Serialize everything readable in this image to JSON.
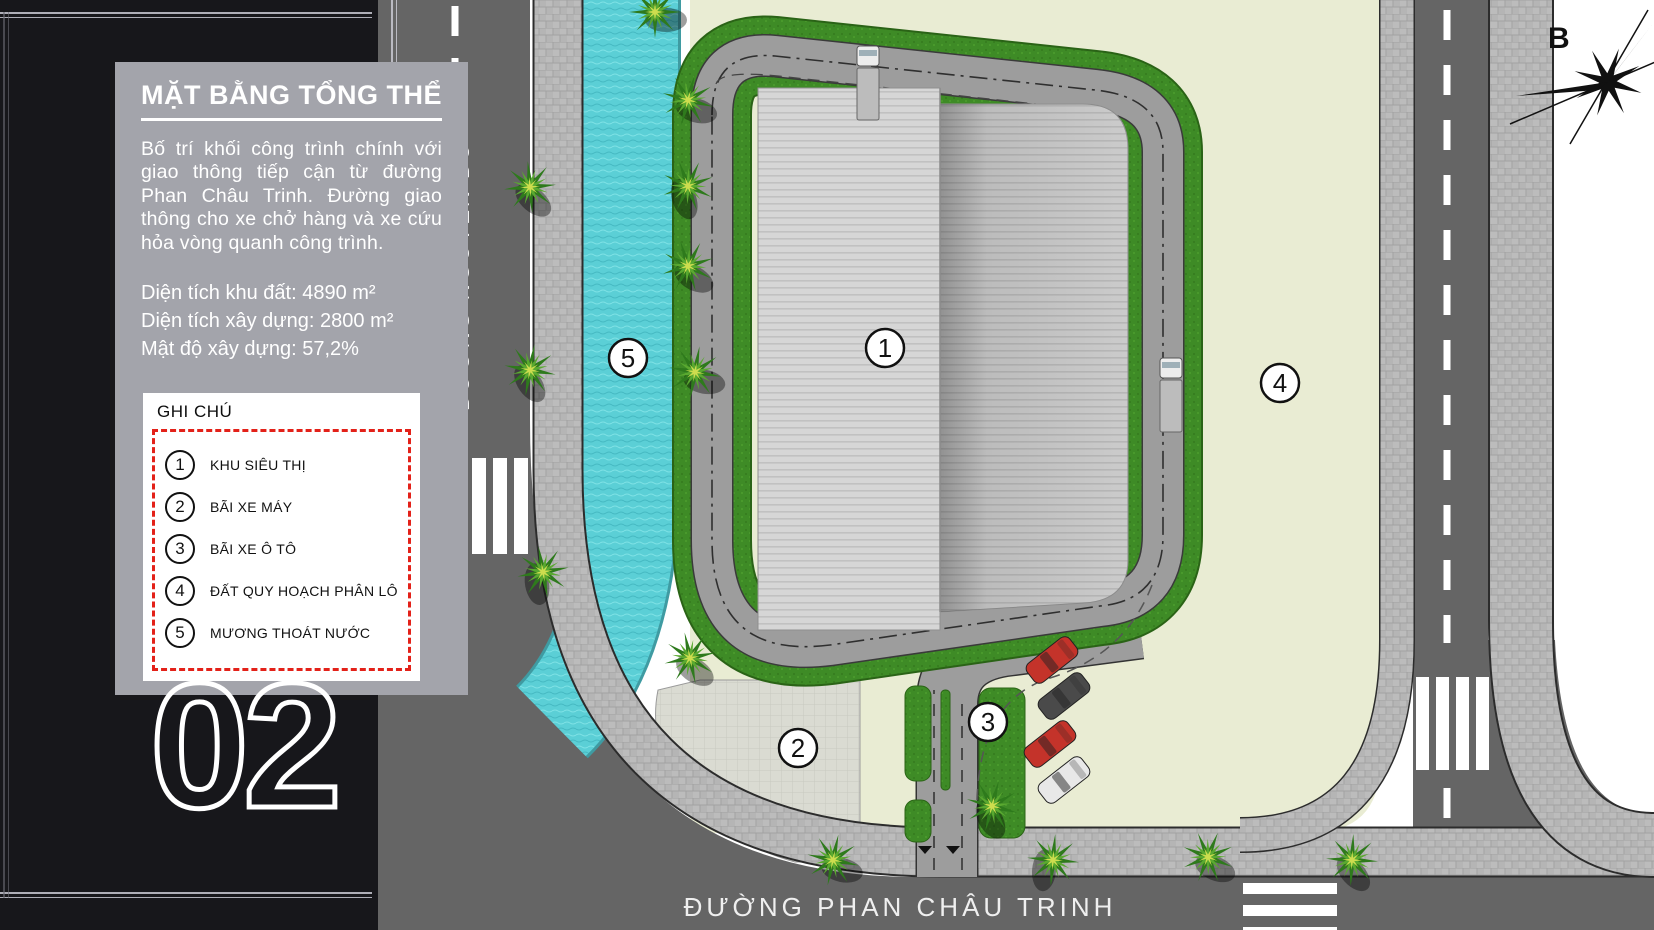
{
  "sidebar": {
    "title": "MẶT BẰNG TỔNG THỂ",
    "description": "Bố trí khối công trình chính với giao thông tiếp cận từ đường Phan Châu Trinh. Đường giao thông cho xe chở hàng và xe cứu hỏa vòng quanh công trình.",
    "stats": [
      "Diện tích khu đất: 4890 m²",
      "Diện tích xây dựng: 2800 m²",
      "Mật độ xây dựng: 57,2%"
    ],
    "page_number": "02"
  },
  "legend": {
    "title": "GHI CHÚ",
    "items": [
      {
        "number": "1",
        "label": "KHU SIÊU THỊ"
      },
      {
        "number": "2",
        "label": "BÃI XE MÁY"
      },
      {
        "number": "3",
        "label": "BÃI XE Ô TÔ"
      },
      {
        "number": "4",
        "label": "ĐẤT QUY HOẠCH PHÂN LÔ"
      },
      {
        "number": "5",
        "label": "MƯƠNG THOÁT NƯỚC"
      }
    ]
  },
  "map": {
    "road_left_label": "ĐƯỜNG NGUYỄN DU",
    "road_bottom_label": "ĐƯỜNG PHAN CHÂU TRINH",
    "compass_label": "B",
    "markers": [
      "1",
      "2",
      "3",
      "4",
      "5"
    ],
    "colors": {
      "accent_red": "#e32119",
      "water": "#5bcfd6",
      "grass": "#3e8b26",
      "asphalt": "#656565",
      "ring_road": "#9d9d9d",
      "planned_land": "#e9ecd3",
      "panel_gray": "#a3a4ab",
      "sidebar_black": "#17171b"
    }
  }
}
